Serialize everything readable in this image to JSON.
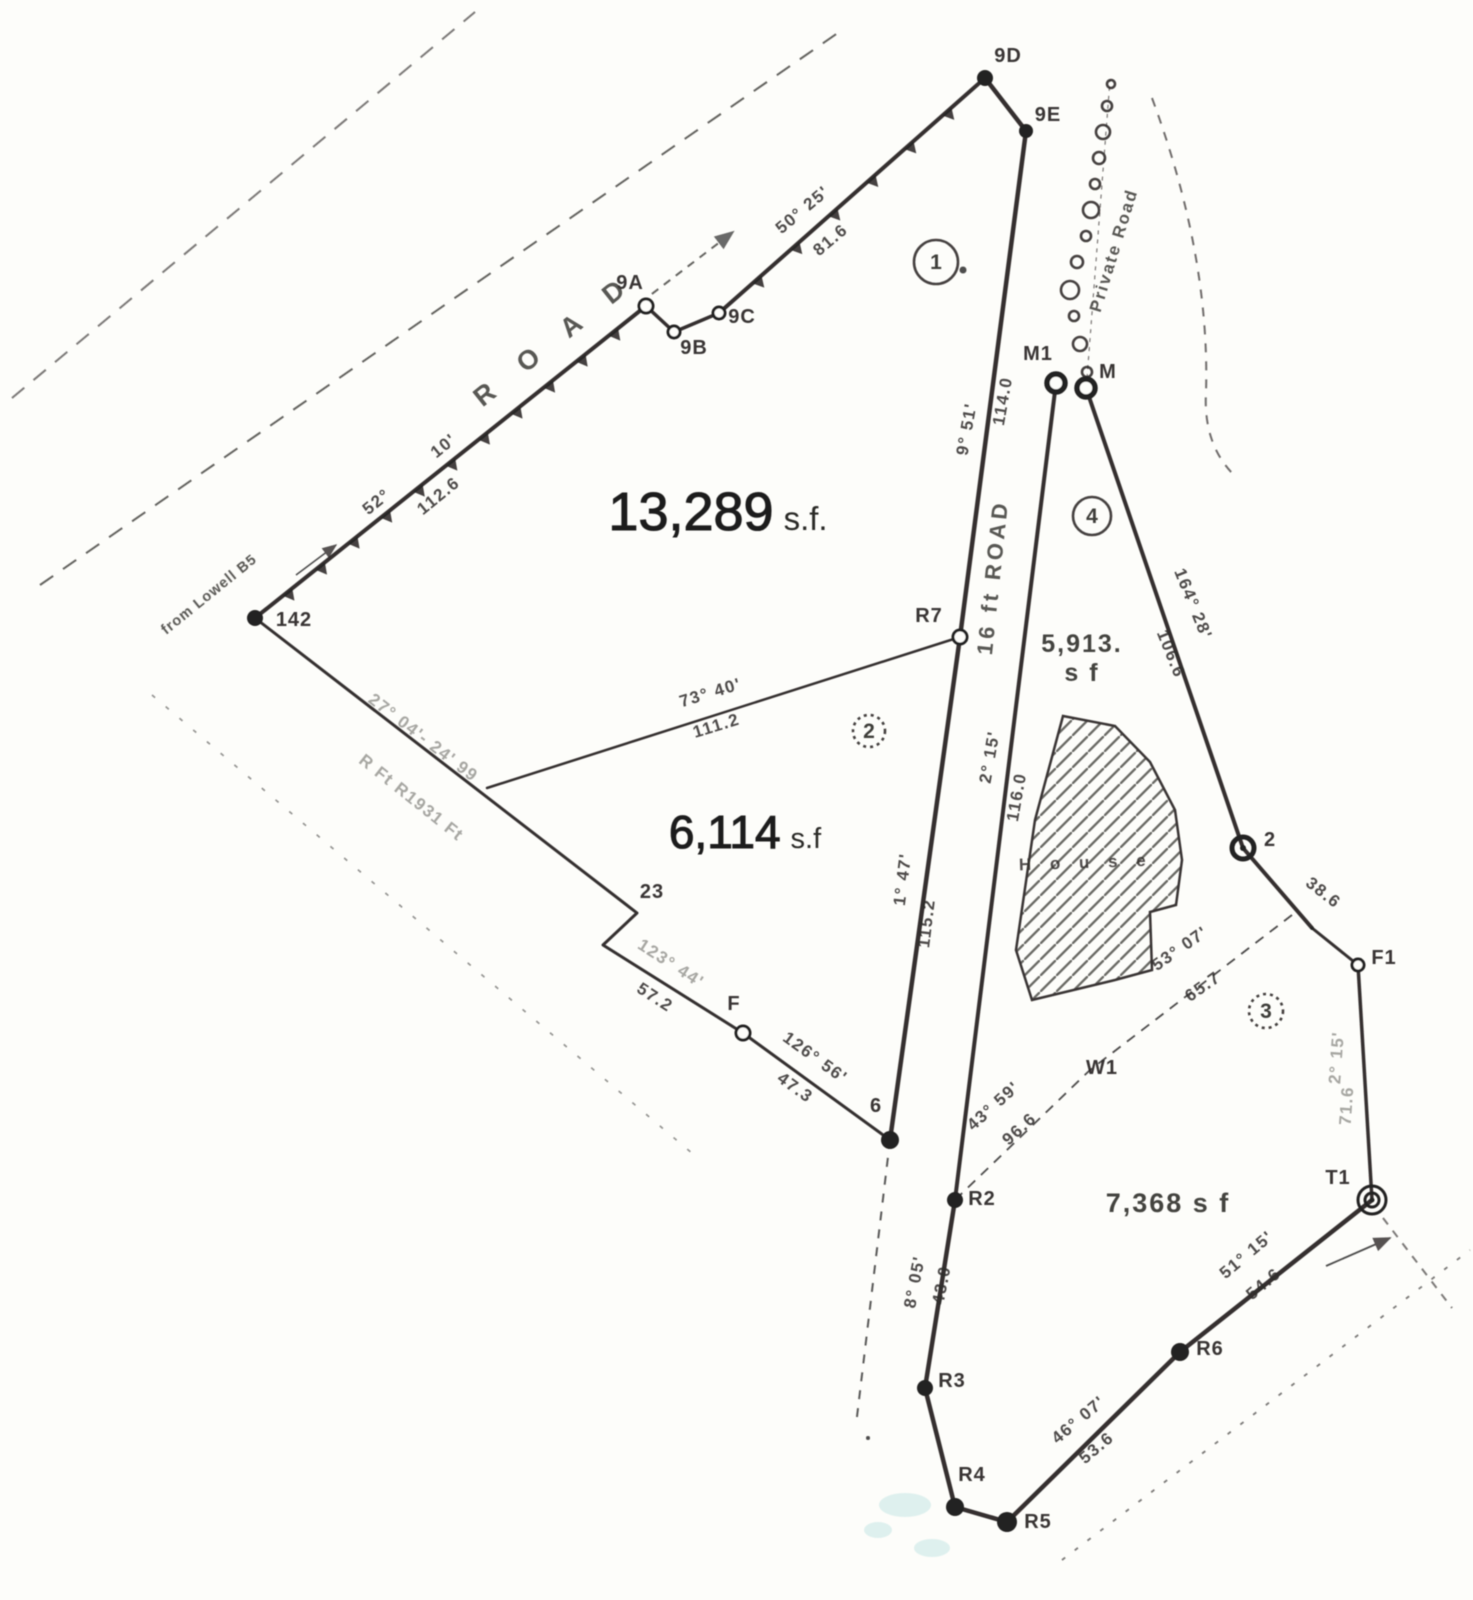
{
  "document": {
    "kind": "scanned survey plat",
    "background": "#fdfdfa",
    "ink": "#232120",
    "width": 1473,
    "height": 1600
  },
  "parcels": [
    {
      "id": "1",
      "number": "1",
      "circle": {
        "x": 936,
        "y": 262,
        "r": 22,
        "style": "solid"
      },
      "area": {
        "x": 718,
        "y": 530,
        "num": "13,289",
        "suffix": "s.f.",
        "num_size": 54,
        "suffix_size": 33
      }
    },
    {
      "id": "2",
      "number": "2",
      "circle": {
        "x": 869,
        "y": 731,
        "r": 16,
        "style": "dotted"
      },
      "area": {
        "x": 745,
        "y": 848,
        "num": "6,114",
        "suffix": "s.f",
        "num_size": 46,
        "suffix_size": 29
      }
    },
    {
      "id": "4",
      "number": "4",
      "circle": {
        "x": 1092,
        "y": 516,
        "r": 19,
        "style": "solid"
      },
      "area": {
        "x": 1082,
        "y": 652,
        "lines": [
          "5,913.",
          "s f"
        ],
        "size": 25
      }
    },
    {
      "id": "3",
      "number": "3",
      "circle": {
        "x": 1266,
        "y": 1011,
        "r": 17,
        "style": "dotted"
      },
      "area": {
        "x": 1168,
        "y": 1212,
        "lines": [
          "7,368 s f"
        ],
        "size": 27
      }
    }
  ],
  "roads": [
    {
      "id": "road-top-left",
      "name": "R O A D",
      "x": 560,
      "y": 346,
      "rotate": -38.5,
      "size": 27,
      "spacing": 14
    },
    {
      "id": "road-16ft",
      "name": "16 ft ROAD",
      "x": 1000,
      "y": 578,
      "rotate": -84,
      "size": 22,
      "spacing": 4
    },
    {
      "id": "private-road",
      "name": "Private Road",
      "x": 1119,
      "y": 252,
      "rotate": -73,
      "size": 17,
      "spacing": 2
    },
    {
      "id": "from-lowell",
      "name": "from Lowell B5",
      "x": 212,
      "y": 598,
      "rotate": -39,
      "size": 14.5,
      "spacing": 1,
      "faint": true
    }
  ],
  "points": [
    {
      "label": "9D",
      "x": 985,
      "y": 78,
      "marker": "filled",
      "r": 8,
      "lx": 1008,
      "ly": 62
    },
    {
      "label": "9E",
      "x": 1026,
      "y": 131,
      "marker": "filled",
      "r": 7,
      "lx": 1048,
      "ly": 121
    },
    {
      "label": "9A",
      "x": 646,
      "y": 306,
      "marker": "open",
      "r": 7,
      "lx": 630,
      "ly": 289
    },
    {
      "label": "9B",
      "x": 674,
      "y": 332,
      "marker": "open",
      "r": 6,
      "lx": 694,
      "ly": 354
    },
    {
      "label": "9C",
      "x": 719,
      "y": 313,
      "marker": "open",
      "r": 6,
      "lx": 742,
      "ly": 323
    },
    {
      "label": "142",
      "x": 255,
      "y": 618,
      "marker": "filled",
      "r": 8,
      "lx": 294,
      "ly": 626
    },
    {
      "label": "R7",
      "x": 960,
      "y": 637,
      "marker": "open",
      "r": 7,
      "lx": 929,
      "ly": 622
    },
    {
      "label": "M1",
      "x": 1056,
      "y": 383,
      "marker": "bold",
      "r": 9,
      "lx": 1038,
      "ly": 360
    },
    {
      "label": "M",
      "x": 1086,
      "y": 388,
      "marker": "bold",
      "r": 9,
      "lx": 1108,
      "ly": 378
    },
    {
      "label": "2",
      "x": 1243,
      "y": 848,
      "marker": "ringdot",
      "r": 11,
      "lx": 1270,
      "ly": 846
    },
    {
      "label": "F1",
      "x": 1358,
      "y": 965,
      "marker": "open",
      "r": 6,
      "lx": 1384,
      "ly": 964
    },
    {
      "label": "T1",
      "x": 1372,
      "y": 1200,
      "marker": "double",
      "r": 14,
      "lx": 1338,
      "ly": 1184
    },
    {
      "label": "W1",
      "x": null,
      "y": null,
      "marker": "none",
      "lx": 1102,
      "ly": 1074
    },
    {
      "label": "6",
      "x": 890,
      "y": 1140,
      "marker": "filled",
      "r": 9,
      "lx": 876,
      "ly": 1112
    },
    {
      "label": "F",
      "x": 743,
      "y": 1033,
      "marker": "open",
      "r": 7,
      "lx": 734,
      "ly": 1010
    },
    {
      "label": "23",
      "x": null,
      "y": null,
      "marker": "none",
      "lx": 652,
      "ly": 898
    },
    {
      "label": "R2",
      "x": 955,
      "y": 1200,
      "marker": "filled",
      "r": 8,
      "lx": 982,
      "ly": 1205
    },
    {
      "label": "R3",
      "x": 925,
      "y": 1388,
      "marker": "filled",
      "r": 8,
      "lx": 952,
      "ly": 1387
    },
    {
      "label": "R4",
      "x": 955,
      "y": 1507,
      "marker": "filled",
      "r": 9,
      "lx": 972,
      "ly": 1481
    },
    {
      "label": "R5",
      "x": 1007,
      "y": 1522,
      "marker": "filled",
      "r": 10,
      "lx": 1038,
      "ly": 1528
    },
    {
      "label": "R6",
      "x": 1180,
      "y": 1352,
      "marker": "filled",
      "r": 9,
      "lx": 1210,
      "ly": 1355
    }
  ],
  "solid_lines": [
    {
      "id": "bound-142-9a",
      "pts": [
        [
          255,
          618
        ],
        [
          646,
          306
        ]
      ],
      "w": 4
    },
    {
      "id": "bound-9a-9b-9c",
      "pts": [
        [
          646,
          306
        ],
        [
          674,
          332
        ],
        [
          719,
          313
        ]
      ],
      "w": 3.5
    },
    {
      "id": "bound-9c-9d",
      "pts": [
        [
          719,
          313
        ],
        [
          985,
          78
        ]
      ],
      "w": 4
    },
    {
      "id": "bound-9d-9e",
      "pts": [
        [
          985,
          78
        ],
        [
          1026,
          131
        ]
      ],
      "w": 4.5
    },
    {
      "id": "road16-west-edge",
      "pts": [
        [
          1026,
          131
        ],
        [
          960,
          637
        ],
        [
          890,
          1140
        ]
      ],
      "w": 4.5
    },
    {
      "id": "road16-east-edge",
      "pts": [
        [
          1056,
          383
        ],
        [
          955,
          1200
        ]
      ],
      "w": 4
    },
    {
      "id": "bound-south",
      "pts": [
        [
          955,
          1200
        ],
        [
          925,
          1388
        ],
        [
          955,
          1507
        ],
        [
          1007,
          1522
        ],
        [
          1180,
          1352
        ],
        [
          1372,
          1200
        ]
      ],
      "w": 4.5
    },
    {
      "id": "line-73-40",
      "pts": [
        [
          487,
          788
        ],
        [
          960,
          637
        ]
      ],
      "w": 2.5
    },
    {
      "id": "bound-sw",
      "pts": [
        [
          255,
          618
        ],
        [
          637,
          913
        ],
        [
          603,
          945
        ],
        [
          743,
          1033
        ],
        [
          890,
          1140
        ]
      ],
      "w": 3
    },
    {
      "id": "bound-m-2-f1",
      "pts": [
        [
          1086,
          388
        ],
        [
          1243,
          848
        ],
        [
          1312,
          928
        ]
      ],
      "w": 4
    },
    {
      "id": "bound-2-f1",
      "pts": [
        [
          1312,
          928
        ],
        [
          1358,
          965
        ]
      ],
      "w": 3
    },
    {
      "id": "bound-f1-t",
      "pts": [
        [
          1358,
          965
        ],
        [
          1372,
          1200
        ]
      ],
      "w": 3.5
    }
  ],
  "dashed_lines": [
    {
      "id": "road-centerline",
      "pts": [
        [
          40,
          585
        ],
        [
          845,
          28
        ]
      ],
      "dash": "16 12",
      "w": 2,
      "op": 0.7
    },
    {
      "id": "road-nw-edge",
      "pts": [
        [
          12,
          398
        ],
        [
          475,
          12
        ]
      ],
      "dash": "16 12",
      "w": 2,
      "op": 0.6
    },
    {
      "id": "row-lower-left",
      "pts": [
        [
          152,
          695
        ],
        [
          700,
          1160
        ]
      ],
      "dash": "4 14",
      "w": 1.6,
      "op": 0.5
    },
    {
      "id": "dash-below-6",
      "pts": [
        [
          890,
          1140
        ],
        [
          856,
          1425
        ]
      ],
      "dash": "9 9",
      "w": 2,
      "op": 0.75
    },
    {
      "id": "driveway-dash",
      "pts": [
        [
          640,
          303
        ],
        [
          733,
          232
        ]
      ],
      "dash": "8 7",
      "w": 2,
      "op": 0.7,
      "arrow": true
    },
    {
      "id": "road-br-edge",
      "pts": [
        [
          1062,
          1560
        ],
        [
          1470,
          1250
        ]
      ],
      "dash": "4 12",
      "w": 1.8,
      "op": 0.6
    },
    {
      "id": "dash-past-t",
      "pts": [
        [
          1383,
          1218
        ],
        [
          1452,
          1308
        ]
      ],
      "dash": "8 8",
      "w": 2,
      "op": 0.6
    },
    {
      "id": "bound-w1-dashed",
      "pts": [
        [
          955,
          1200
        ],
        [
          1090,
          1070
        ],
        [
          1292,
          915
        ]
      ],
      "dash": "10 8",
      "w": 1.8,
      "op": 0.8
    }
  ],
  "curves": [
    {
      "id": "private-road-east-edge",
      "d": "M 1152 98 Q 1210 255 1206 392 Q 1203 445 1235 476",
      "dash": "9 9",
      "w": 2,
      "op": 0.65
    }
  ],
  "tick_lines": [
    {
      "id": "ticks-142-9a",
      "from": [
        255,
        618
      ],
      "to": [
        646,
        306
      ],
      "n": 11,
      "len": 11,
      "base": 6
    },
    {
      "id": "ticks-9c-9d",
      "from": [
        719,
        313
      ],
      "to": [
        985,
        78
      ],
      "n": 6,
      "len": 11,
      "base": 6
    }
  ],
  "measurements": [
    {
      "text": "50° 25'",
      "x": 806,
      "y": 214,
      "rot": -40
    },
    {
      "text": "81.6",
      "x": 834,
      "y": 244,
      "rot": -40
    },
    {
      "text": "52°",
      "x": 380,
      "y": 506,
      "rot": -39
    },
    {
      "text": "10'",
      "x": 447,
      "y": 450,
      "rot": -39
    },
    {
      "text": "112.6",
      "x": 442,
      "y": 500,
      "rot": -39
    },
    {
      "text": "73°  40'",
      "x": 712,
      "y": 698,
      "rot": -17
    },
    {
      "text": "111.2",
      "x": 718,
      "y": 731,
      "rot": -17
    },
    {
      "text": "27° 04'- 24'  99",
      "x": 420,
      "y": 742,
      "rot": 37.5,
      "cls": "faint"
    },
    {
      "text": "R Ft R1931 Ft",
      "x": 408,
      "y": 802,
      "rot": 38.5,
      "cls": "faint"
    },
    {
      "text": "9° 51'",
      "x": 972,
      "y": 430,
      "rot": -80
    },
    {
      "text": "114.0",
      "x": 1008,
      "y": 402,
      "rot": -80
    },
    {
      "text": "2° 15'",
      "x": 995,
      "y": 758,
      "rot": -80
    },
    {
      "text": "116.0",
      "x": 1022,
      "y": 798,
      "rot": -80
    },
    {
      "text": "1° 47'",
      "x": 908,
      "y": 880,
      "rot": -83
    },
    {
      "text": "115.2",
      "x": 932,
      "y": 924,
      "rot": -83
    },
    {
      "text": "164° 28'",
      "x": 1188,
      "y": 606,
      "rot": 68
    },
    {
      "text": "106.6",
      "x": 1166,
      "y": 656,
      "rot": 68
    },
    {
      "text": "38.6",
      "x": 1320,
      "y": 897,
      "rot": 38
    },
    {
      "text": "2° 15'",
      "x": 1342,
      "y": 1058,
      "rot": -86,
      "cls": "faint"
    },
    {
      "text": "71.6",
      "x": 1352,
      "y": 1106,
      "rot": -86,
      "cls": "faint"
    },
    {
      "text": "53° 07'",
      "x": 1183,
      "y": 953,
      "rot": -35
    },
    {
      "text": "65.7",
      "x": 1206,
      "y": 991,
      "rot": -35
    },
    {
      "text": "43° 59'",
      "x": 997,
      "y": 1110,
      "rot": -42
    },
    {
      "text": "96.6",
      "x": 1023,
      "y": 1133,
      "rot": -42
    },
    {
      "text": "8° 05'",
      "x": 920,
      "y": 1283,
      "rot": -79
    },
    {
      "text": "43.0",
      "x": 947,
      "y": 1286,
      "rot": -79
    },
    {
      "text": "123° 44'",
      "x": 668,
      "y": 968,
      "rot": 33,
      "cls": "faint"
    },
    {
      "text": "57.2",
      "x": 652,
      "y": 1002,
      "rot": 33
    },
    {
      "text": "126° 56'",
      "x": 812,
      "y": 1062,
      "rot": 36
    },
    {
      "text": "47.3",
      "x": 792,
      "y": 1092,
      "rot": 36
    },
    {
      "text": "46° 07'",
      "x": 1082,
      "y": 1424,
      "rot": -40
    },
    {
      "text": "53.6",
      "x": 1100,
      "y": 1452,
      "rot": -40
    },
    {
      "text": "51° 15'",
      "x": 1250,
      "y": 1259,
      "rot": -40
    },
    {
      "text": "54.6",
      "x": 1267,
      "y": 1288,
      "rot": -40
    }
  ],
  "house": {
    "outline": [
      [
        1063,
        716
      ],
      [
        1115,
        726
      ],
      [
        1150,
        762
      ],
      [
        1175,
        810
      ],
      [
        1182,
        860
      ],
      [
        1176,
        905
      ],
      [
        1150,
        912
      ],
      [
        1152,
        970
      ],
      [
        1115,
        980
      ],
      [
        1032,
        1000
      ],
      [
        1016,
        950
      ],
      [
        1035,
        820
      ]
    ],
    "label": {
      "text": "H o u s e",
      "x": 1086,
      "y": 868,
      "rot": -2
    }
  },
  "wall_circles": {
    "spine": [
      [
        1087,
        378
      ],
      [
        1110,
        80
      ]
    ],
    "circles": [
      {
        "x": 1087,
        "y": 372,
        "r": 5
      },
      {
        "x": 1080,
        "y": 344,
        "r": 7
      },
      {
        "x": 1074,
        "y": 316,
        "r": 5
      },
      {
        "x": 1070,
        "y": 290,
        "r": 9
      },
      {
        "x": 1077,
        "y": 262,
        "r": 6
      },
      {
        "x": 1086,
        "y": 236,
        "r": 5
      },
      {
        "x": 1091,
        "y": 210,
        "r": 8
      },
      {
        "x": 1095,
        "y": 184,
        "r": 5
      },
      {
        "x": 1099,
        "y": 158,
        "r": 6
      },
      {
        "x": 1103,
        "y": 132,
        "r": 7
      },
      {
        "x": 1107,
        "y": 106,
        "r": 5
      },
      {
        "x": 1111,
        "y": 84,
        "r": 4
      }
    ]
  },
  "arrows": [
    {
      "id": "arrow-from-lowell",
      "pts": [
        [
          296,
          575
        ],
        [
          336,
          545
        ]
      ],
      "w": 1.5
    },
    {
      "id": "arrow-bottom-right",
      "pts": [
        [
          1326,
          1266
        ],
        [
          1390,
          1238
        ]
      ],
      "w": 1.8
    }
  ],
  "artifacts": {
    "stray_dots": [
      {
        "x": 963,
        "y": 270,
        "r": 3.5
      },
      {
        "x": 868,
        "y": 1438,
        "r": 2
      }
    ],
    "cyan_smudges": [
      {
        "x": 905,
        "y": 1505,
        "rx": 26,
        "ry": 12
      },
      {
        "x": 932,
        "y": 1548,
        "rx": 18,
        "ry": 9
      },
      {
        "x": 878,
        "y": 1530,
        "rx": 14,
        "ry": 8
      }
    ]
  }
}
